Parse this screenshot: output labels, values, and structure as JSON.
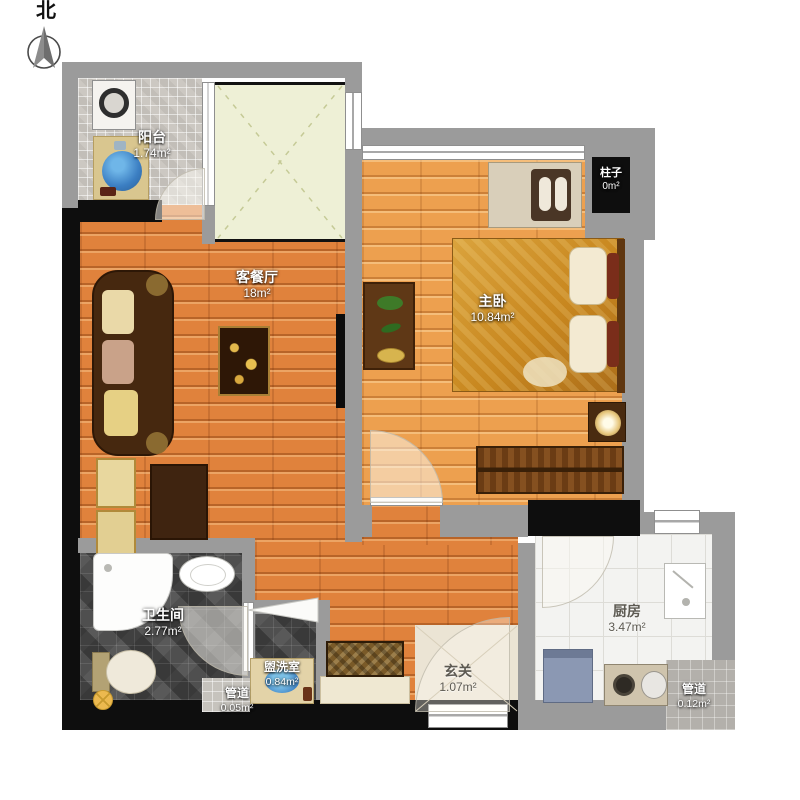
{
  "compass": {
    "label": "北"
  },
  "rooms": {
    "balcony": {
      "name": "阳台",
      "area": "1.74m²"
    },
    "living": {
      "name": "客餐厅",
      "area": "18m²"
    },
    "bedroom": {
      "name": "主卧",
      "area": "10.84m²"
    },
    "pillar": {
      "name": "柱子",
      "area": "0m²"
    },
    "bathroom": {
      "name": "卫生间",
      "area": "2.77m²"
    },
    "washroom": {
      "name": "盥洗室",
      "area": "0.84m²"
    },
    "pipe_small": {
      "name": "管道",
      "area": "0.05m²"
    },
    "entry": {
      "name": "玄关",
      "area": "1.07m²"
    },
    "kitchen": {
      "name": "厨房",
      "area": "3.47m²"
    },
    "pipe_large": {
      "name": "管道",
      "area": "0.12m²"
    }
  },
  "colors": {
    "wall_gray": "#9b9b9b",
    "wall_black": "#0e0e0e",
    "wood_living": "#e0823c",
    "wood_bedroom": "#eda04f",
    "tile_dark": "#4f4f4f",
    "tile_balcony": "#ccc8c2",
    "kitchen_floor": "#f3f3f1",
    "void_fill": "#eef0d6",
    "entry_fill": "#ebe4d4"
  }
}
